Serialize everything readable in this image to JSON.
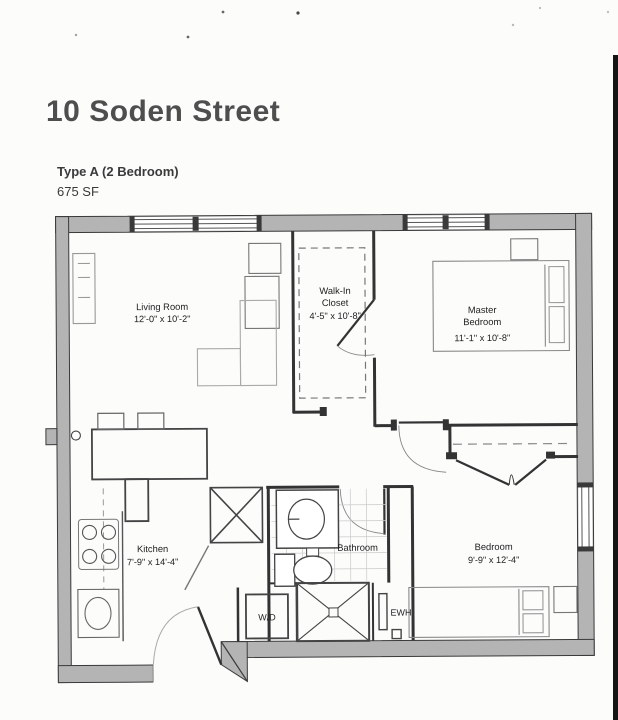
{
  "page": {
    "title": "10 Soden Street",
    "type_label": "Type A (2 Bedroom)",
    "area_label": "675 SF"
  },
  "rooms": {
    "living_room": {
      "name": "Living Room",
      "dims": "12'-0\" x 10'-2\""
    },
    "walk_in_closet": {
      "name_line1": "Walk-In",
      "name_line2": "Closet",
      "dims": "4'-5\" x 10'-8\""
    },
    "master_bedroom": {
      "name_line1": "Master",
      "name_line2": "Bedroom",
      "dims": "11'-1\" x 10'-8\""
    },
    "kitchen": {
      "name": "Kitchen",
      "dims": "7'-9\" x 14'-4\""
    },
    "bathroom": {
      "name": "Bathroom"
    },
    "bedroom": {
      "name": "Bedroom",
      "dims": "9'-9\" x 12'-4\""
    },
    "laundry": {
      "label": "W/D"
    },
    "water_heater": {
      "label": "EWH"
    }
  },
  "colors": {
    "paper": "#fcfcfb",
    "wall_fill": "#b4b4b4",
    "wall_line": "#3a3a3a",
    "furniture_line": "#999999",
    "scan_mark": "#151515"
  }
}
